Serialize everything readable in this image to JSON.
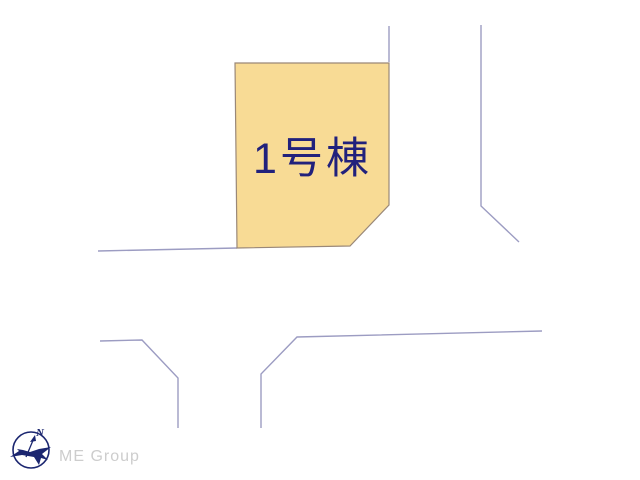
{
  "map": {
    "plots": [
      {
        "label": "1号棟"
      }
    ],
    "compass": {
      "north_label": "N"
    },
    "watermark": "ME Group"
  },
  "colors": {
    "page_bg": "#FFFFFF",
    "road_line": "#9C9CC2",
    "plot_fill": "#F8DB95",
    "plot_border": "#9A8878",
    "plot_label_text": "#21217C",
    "compass_navy": "#1B2670",
    "watermark_gray": "#CDCDCD"
  }
}
